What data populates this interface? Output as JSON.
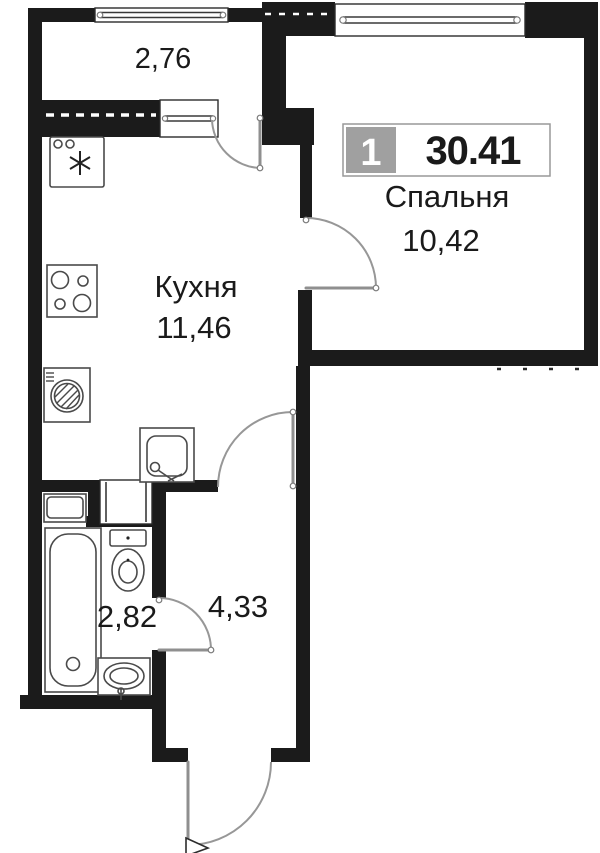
{
  "plan": {
    "title": "1-room apartment floor plan",
    "badge": {
      "rooms": "1",
      "total_area": "30.41"
    },
    "rooms": {
      "balcony": {
        "area": "2,76"
      },
      "bedroom": {
        "name": "Спальня",
        "area": "10,42"
      },
      "kitchen": {
        "name": "Кухня",
        "area": "11,46"
      },
      "hallway": {
        "area": "4,33"
      },
      "bathroom": {
        "area": "2,82"
      }
    },
    "fixtures": [
      "fridge-icon",
      "stove-icon",
      "washing-machine-icon",
      "kitchen-sink-icon",
      "bathtub-icon",
      "toilet-icon",
      "bathroom-sink-icon",
      "snowflake-icon"
    ],
    "colors": {
      "wall": "#1b1b1b",
      "badge_gray": "#a0a0a0",
      "text": "#1a1a1a",
      "door_arc": "#979797"
    }
  }
}
